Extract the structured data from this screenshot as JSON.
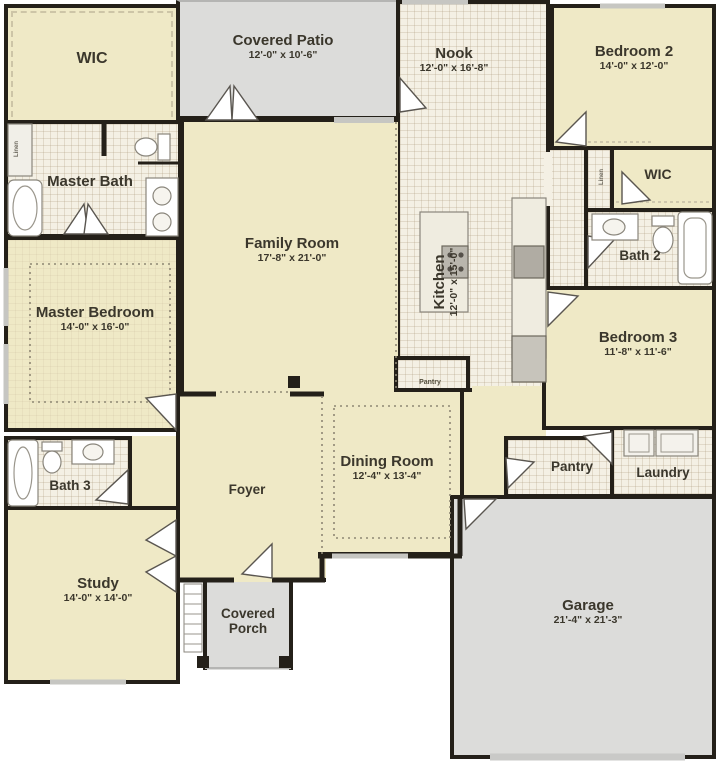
{
  "plan": {
    "title": "Single-story house floor plan",
    "colors": {
      "wall": "#242019",
      "room_cream": "#efe9c6",
      "tile_floor": "#f4f0e4",
      "patio_gray": "#dcdcda",
      "label_text": "#3b372c"
    },
    "rooms": {
      "wic_master": {
        "name": "WIC"
      },
      "covered_patio": {
        "name": "Covered Patio",
        "dims": "12'-0\" x 10'-6\""
      },
      "nook": {
        "name": "Nook",
        "dims": "12'-0\" x 16'-8\""
      },
      "bedroom2": {
        "name": "Bedroom 2",
        "dims": "14'-0\" x 12'-0\""
      },
      "wic2": {
        "name": "WIC"
      },
      "linen_hall": {
        "name": "Linen"
      },
      "bath2": {
        "name": "Bath 2"
      },
      "bedroom3": {
        "name": "Bedroom 3",
        "dims": "11'-8\" x 11'-6\""
      },
      "master_bath": {
        "name": "Master Bath"
      },
      "linen_mbath": {
        "name": "Linen"
      },
      "family_room": {
        "name": "Family Room",
        "dims": "17'-8\" x 21'-0\""
      },
      "kitchen": {
        "name": "Kitchen",
        "dims": "12'-0\" x 15'-0\""
      },
      "master_bedroom": {
        "name": "Master Bedroom",
        "dims": "14'-0\" x 16'-0\""
      },
      "foyer": {
        "name": "Foyer"
      },
      "dining_room": {
        "name": "Dining Room",
        "dims": "12'-4\" x 13'-4\""
      },
      "pantry_closet": {
        "name": "Pantry"
      },
      "bath3": {
        "name": "Bath 3"
      },
      "study": {
        "name": "Study",
        "dims": "14'-0\" x 14'-0\""
      },
      "covered_porch": {
        "name": "Covered Porch"
      },
      "pantry": {
        "name": "Pantry"
      },
      "laundry": {
        "name": "Laundry"
      },
      "garage": {
        "name": "Garage",
        "dims": "21'-4\" x 21'-3\""
      }
    }
  }
}
